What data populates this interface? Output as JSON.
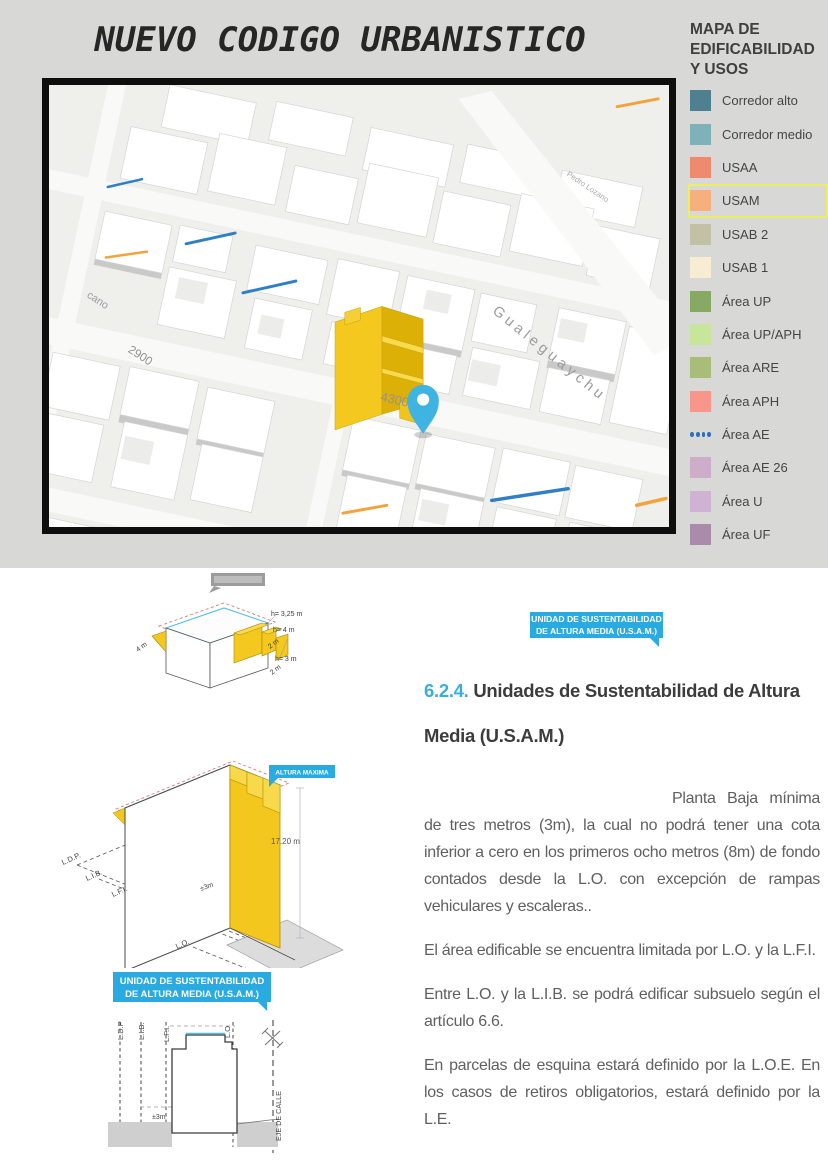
{
  "page": {
    "title": "NUEVO CODIGO URBANISTICO"
  },
  "legend": {
    "title": "MAPA DE EDIFICABILIDAD Y USOS",
    "highlight_border": "#edf05e",
    "items": [
      {
        "label": "Corredor alto",
        "color": "#4e808f"
      },
      {
        "label": "Corredor medio",
        "color": "#7fb2b8"
      },
      {
        "label": "USAA",
        "color": "#ee8a6d"
      },
      {
        "label": "USAM",
        "color": "#f5b07e",
        "highlighted": true
      },
      {
        "label": "USAB 2",
        "color": "#c3c1a5"
      },
      {
        "label": "USAB 1",
        "color": "#f8ecd2"
      },
      {
        "label": "Área UP",
        "color": "#86a963"
      },
      {
        "label": "Área UP/APH",
        "color": "#c7e69b"
      },
      {
        "label": "Área ARE",
        "color": "#a9bd78"
      },
      {
        "label": "Área APH",
        "color": "#f9968c"
      },
      {
        "label": "Área AE",
        "color": "#2e6fbd",
        "type": "dots"
      },
      {
        "label": "Área AE 26",
        "color": "#ceadca"
      },
      {
        "label": "Área U",
        "color": "#cfb3d3"
      },
      {
        "label": "Área UF",
        "color": "#a98caa"
      }
    ]
  },
  "map": {
    "labels": {
      "gualeguaychu": "Gualeguaychu",
      "number_4300": "4300",
      "number_2900": "2900",
      "cano": "cano",
      "pedro_lozano": "Pedro Lozano"
    },
    "highlight_color": "#f2c41d",
    "pin_color": "#3fb4e3"
  },
  "diagram_top": {
    "left_dim": "4 m",
    "right_dims": [
      "h= 3,25 m",
      "h= 4 m",
      "2 m",
      "h= 3 m",
      "2 m"
    ]
  },
  "diagram_mid": {
    "tag": "ALTURA MAXIMA",
    "height_dim": "17.20  m",
    "base_dim": "±3m",
    "lines": [
      "L.D.P.",
      "L.I.B.",
      "L.F.I.",
      "L.O."
    ]
  },
  "usam_banner": {
    "line1": "UNIDAD DE SUSTENTABILIDAD",
    "line2": "DE ALTURA MEDIA (U.S.A.M.)"
  },
  "diagram_section": {
    "lines": [
      "L.D.P",
      "L.I.B.",
      "L.F.I.",
      "L.O"
    ],
    "axis_label": "EJE DE CALLE",
    "base_dim": "±3m"
  },
  "article": {
    "tag_line1": "UNIDAD DE SUSTENTABILIDAD",
    "tag_line2": "DE ALTURA MEDIA (U.S.A.M.)",
    "section_number": "6.2.4.",
    "heading": "Unidades de Sustentabilidad de Altura Media (U.S.A.M.)",
    "paragraphs": [
      "Planta Baja mínima de tres metros (3m), la cual no podrá tener una cota inferior a cero en los primeros ocho metros (8m) de fondo contados desde la L.O. con excepción de rampas vehiculares y escaleras..",
      "El área edificable se encuentra limitada por L.O. y la L.F.I.",
      "Entre L.O. y la L.I.B. se podrá edificar subsuelo según el artículo 6.6.",
      "En parcelas de esquina estará definido por la L.O.E. En los casos de retiros obligatorios, estará definido por la L.E."
    ]
  },
  "colors": {
    "accent_cyan": "#29abe2",
    "yellow": "#f2c41d",
    "top_bg": "#d8d8d6"
  }
}
